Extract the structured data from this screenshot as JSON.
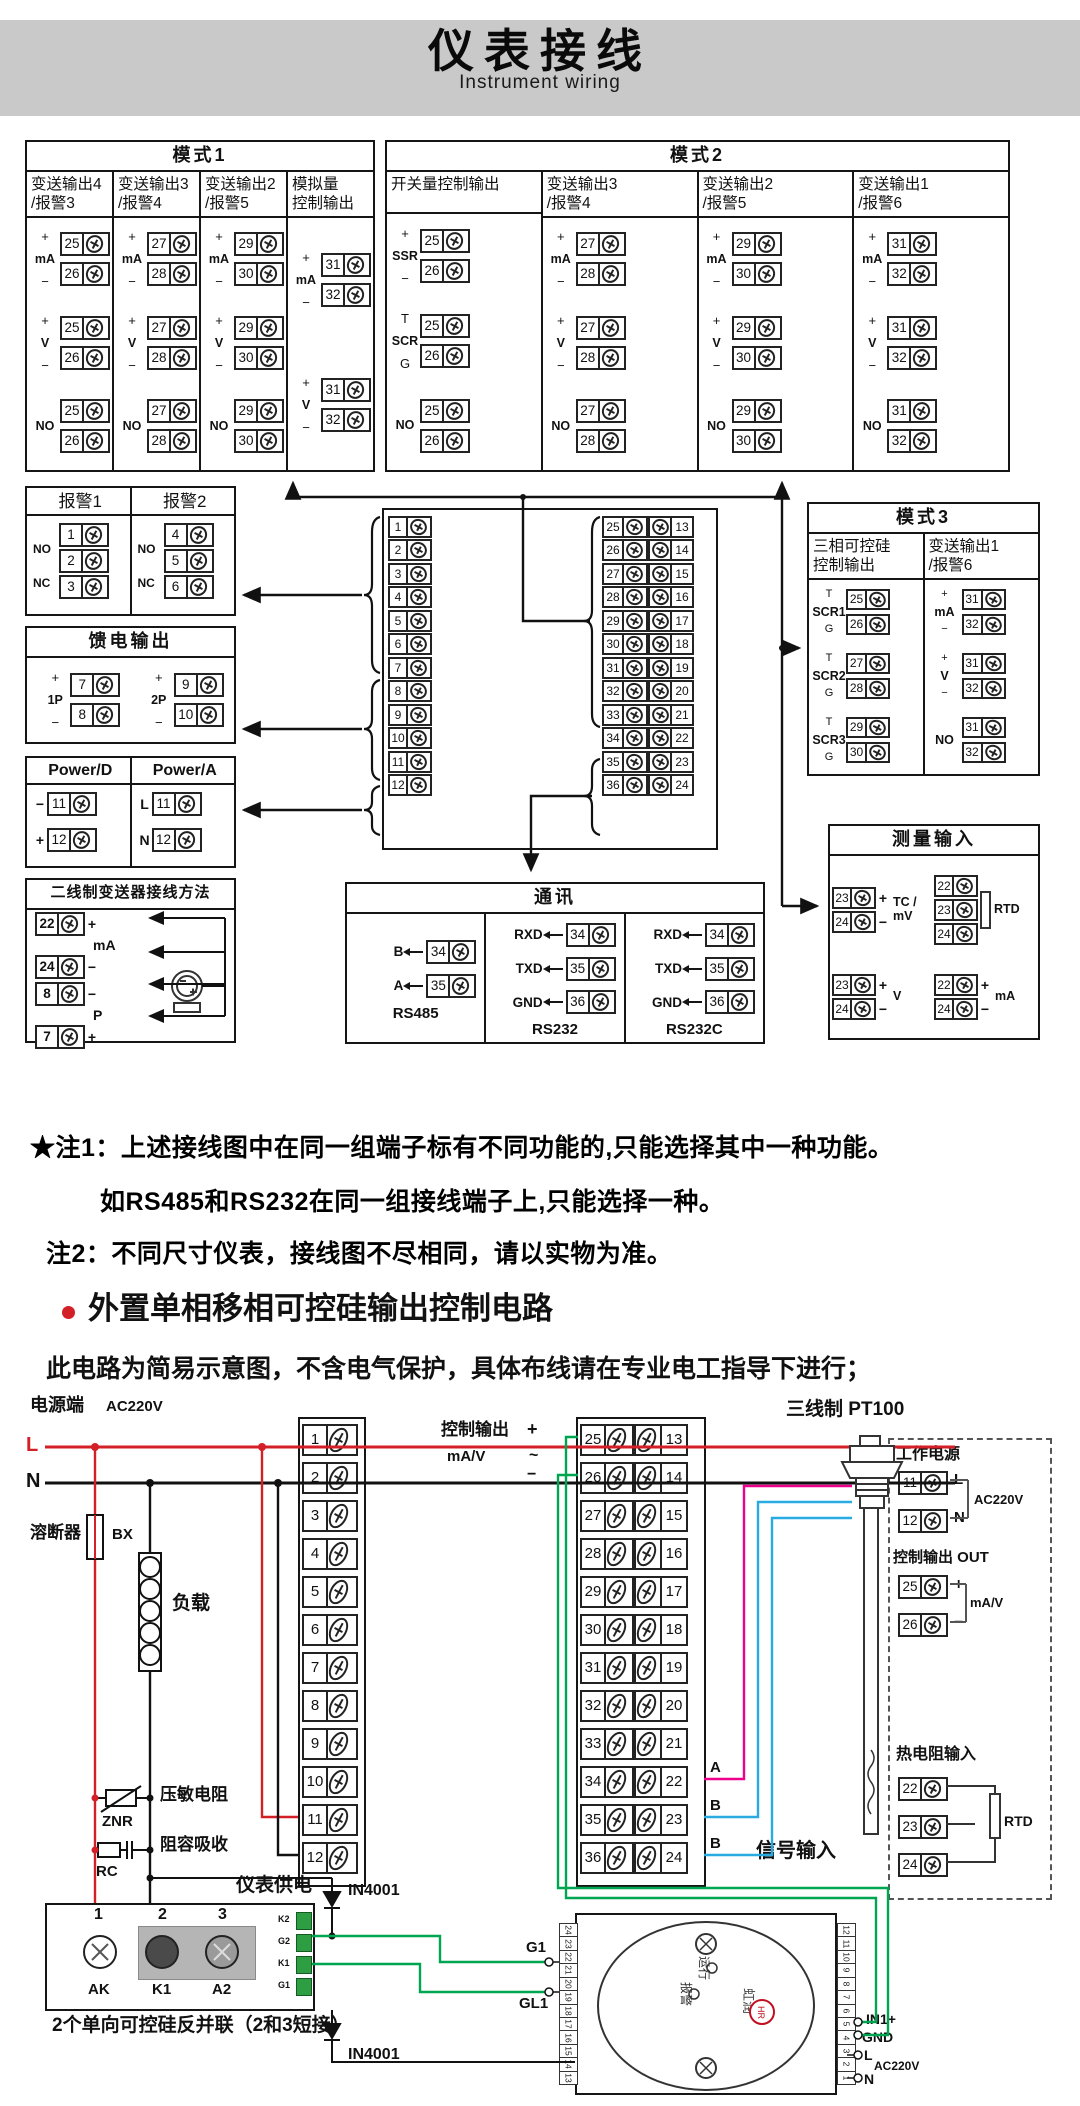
{
  "header": {
    "title_zh": "仪表接线",
    "title_en": "Instrument wiring"
  },
  "notes": {
    "n1a": "★注1：上述接线图中在同一组端子标有不同功能的,只能选择其中一种功能。",
    "n1b": "如RS485和RS232在同一组接线端子上,只能选择一种。",
    "n2": "注2：不同尺寸仪表，接线图不尽相同，请以实物为准。"
  },
  "section2": {
    "title": "外置单相移相可控硅输出控制电路",
    "subtitle": "此电路为简易示意图，不含电气保护，具体布线请在专业电工指导下进行；"
  },
  "mode_boxes": [
    {
      "id": "mode1",
      "title": "模式1",
      "columns": [
        {
          "header": [
            "变送输出4",
            "/报警3"
          ],
          "groups": [
            [
              "+",
              "mA",
              "−",
              "25",
              "26"
            ],
            [
              "+",
              "V",
              "−",
              "25",
              "26"
            ],
            [
              "",
              "NO",
              "",
              "25",
              "26"
            ]
          ]
        },
        {
          "header": [
            "变送输出3",
            "/报警4"
          ],
          "groups": [
            [
              "+",
              "mA",
              "−",
              "27",
              "28"
            ],
            [
              "+",
              "V",
              "−",
              "27",
              "28"
            ],
            [
              "",
              "NO",
              "",
              "27",
              "28"
            ]
          ]
        },
        {
          "header": [
            "变送输出2",
            "/报警5"
          ],
          "groups": [
            [
              "+",
              "mA",
              "−",
              "29",
              "30"
            ],
            [
              "+",
              "V",
              "−",
              "29",
              "30"
            ],
            [
              "",
              "NO",
              "",
              "29",
              "30"
            ]
          ]
        },
        {
          "header": [
            "模拟量",
            "控制输出"
          ],
          "groups": [
            [
              "+",
              "mA",
              "−",
              "31",
              "32"
            ],
            [
              "+",
              "V",
              "−",
              "31",
              "32"
            ]
          ]
        }
      ]
    },
    {
      "id": "mode2",
      "title": "模式2",
      "columns": [
        {
          "header": [
            "开关量控制输出",
            ""
          ],
          "groups": [
            [
              "+",
              "SSR",
              "−",
              "25",
              "26"
            ],
            [
              "T",
              "SCR",
              "G",
              "25",
              "26"
            ],
            [
              "",
              "NO",
              "",
              "25",
              "26"
            ]
          ]
        },
        {
          "header": [
            "变送输出3",
            "/报警4"
          ],
          "groups": [
            [
              "+",
              "mA",
              "−",
              "27",
              "28"
            ],
            [
              "+",
              "V",
              "−",
              "27",
              "28"
            ],
            [
              "",
              "NO",
              "",
              "27",
              "28"
            ]
          ]
        },
        {
          "header": [
            "变送输出2",
            "/报警5"
          ],
          "groups": [
            [
              "+",
              "mA",
              "−",
              "29",
              "30"
            ],
            [
              "+",
              "V",
              "−",
              "29",
              "30"
            ],
            [
              "",
              "NO",
              "",
              "29",
              "30"
            ]
          ]
        },
        {
          "header": [
            "变送输出1",
            "/报警6"
          ],
          "groups": [
            [
              "+",
              "mA",
              "−",
              "31",
              "32"
            ],
            [
              "+",
              "V",
              "−",
              "31",
              "32"
            ],
            [
              "",
              "NO",
              "",
              "31",
              "32"
            ]
          ]
        }
      ]
    },
    {
      "id": "mode3",
      "title": "模式3",
      "columns": [
        {
          "header": [
            "三相可控硅",
            "控制输出"
          ],
          "groups": [
            [
              "T",
              "SCR1",
              "G",
              "25",
              "26"
            ],
            [
              "T",
              "SCR2",
              "G",
              "27",
              "28"
            ],
            [
              "T",
              "SCR3",
              "G",
              "29",
              "30"
            ]
          ]
        },
        {
          "header": [
            "变送输出1",
            "/报警6"
          ],
          "groups": [
            [
              "+",
              "mA",
              "−",
              "31",
              "32"
            ],
            [
              "+",
              "V",
              "−",
              "31",
              "32"
            ],
            [
              "",
              "NO",
              "",
              "31",
              "32"
            ]
          ]
        }
      ]
    }
  ],
  "alarm": {
    "cols": [
      {
        "title": "报警1",
        "terms": [
          "1",
          "2",
          "3"
        ],
        "links": [
          "NO",
          "NC"
        ]
      },
      {
        "title": "报警2",
        "terms": [
          "4",
          "5",
          "6"
        ],
        "links": [
          "NO",
          "NC"
        ]
      }
    ]
  },
  "feed": {
    "title": "馈电输出",
    "groups": [
      [
        "+",
        "1P",
        "−",
        "7",
        "8"
      ],
      [
        "+",
        "2P",
        "−",
        "9",
        "10"
      ]
    ]
  },
  "power": {
    "cols": [
      {
        "title": "Power/D",
        "rows": [
          [
            "−",
            "11"
          ],
          [
            "+",
            "12"
          ]
        ]
      },
      {
        "title": "Power/A",
        "rows": [
          [
            "L",
            "11"
          ],
          [
            "N",
            "12"
          ]
        ]
      }
    ]
  },
  "twowire": {
    "title": "二线制变送器接线方法",
    "rows": [
      [
        "22",
        "+"
      ],
      [
        "24",
        "−"
      ],
      [
        "8",
        "−"
      ],
      [
        "7",
        "+"
      ]
    ],
    "mid1": "mA",
    "mid2": "P"
  },
  "comm": {
    "title": "通讯",
    "cols": [
      {
        "label": "RS485",
        "rows": [
          [
            "B",
            "34"
          ],
          [
            "A",
            "35"
          ]
        ]
      },
      {
        "label": "RS232",
        "rows": [
          [
            "RXD",
            "34"
          ],
          [
            "TXD",
            "35"
          ],
          [
            "GND",
            "36"
          ]
        ]
      },
      {
        "label": "RS232C",
        "rows": [
          [
            "RXD",
            "34"
          ],
          [
            "TXD",
            "35"
          ],
          [
            "GND",
            "36"
          ]
        ]
      }
    ]
  },
  "measure": {
    "title": "测量输入",
    "groups": [
      {
        "terms": [
          [
            "23",
            "+"
          ],
          [
            "24",
            "−"
          ]
        ],
        "label": "TC / mV"
      },
      {
        "terms": [
          [
            "22",
            ""
          ],
          [
            "23",
            ""
          ],
          [
            "24",
            ""
          ]
        ],
        "label": "RTD"
      },
      {
        "terms": [
          [
            "23",
            "+"
          ],
          [
            "24",
            "−"
          ]
        ],
        "label": "V"
      },
      {
        "terms": [
          [
            "22",
            "+"
          ],
          [
            "24",
            "−"
          ]
        ],
        "label": "mA"
      }
    ]
  },
  "strips": {
    "left": [
      "1",
      "2",
      "3",
      "4",
      "5",
      "6",
      "7",
      "8",
      "9",
      "10",
      "11",
      "12"
    ],
    "inner": [
      "25",
      "26",
      "27",
      "28",
      "29",
      "30",
      "31",
      "32",
      "33",
      "34",
      "35",
      "36"
    ],
    "outer": [
      "13",
      "14",
      "15",
      "16",
      "17",
      "18",
      "19",
      "20",
      "21",
      "22",
      "23",
      "24"
    ]
  },
  "bottom": {
    "power_side": "电源端",
    "ac": "AC220V",
    "l": "L",
    "n": "N",
    "fuse": "溶断器",
    "bx": "BX",
    "load": "负载",
    "znr_label": "压敏电阻",
    "znr": "ZNR",
    "rc_label": "阻容吸收",
    "rc": "RC",
    "supply": "仪表供电",
    "ctrl": "控制输出",
    "plus": "+",
    "minus": "−",
    "tilde": "~",
    "mav": "mA/V",
    "abb": [
      "A",
      "B",
      "B"
    ],
    "signal": "信号输入",
    "pt100": "三线制 PT100",
    "diode": "IN4001",
    "module": {
      "nums": [
        "1",
        "2",
        "3"
      ],
      "pins": [
        "AK",
        "K1",
        "A2"
      ],
      "mini": [
        "K2",
        "G2",
        "K1",
        "G1"
      ],
      "caption": "2个单向可控硅反并联（2和3短接）"
    },
    "panel": {
      "power_title": "工作电源",
      "power_rows": [
        [
          "11",
          "L"
        ],
        [
          "12",
          "N"
        ]
      ],
      "ac": "AC220V",
      "out_title": "控制输出 OUT",
      "out_rows": [
        [
          "25",
          "+"
        ],
        [
          "26",
          "−"
        ]
      ],
      "mav": "mA/V",
      "rtd_title": "热电阻输入",
      "rtd_rows": [
        "22",
        "23",
        "24"
      ],
      "rtd": "RTD"
    },
    "device": {
      "left_nums": [
        "24",
        "23",
        "22",
        "21",
        "20",
        "19",
        "18",
        "17",
        "16",
        "15",
        "14",
        "13"
      ],
      "right_nums": [
        "12",
        "11",
        "10",
        "9",
        "8",
        "7",
        "6",
        "5",
        "4",
        "3",
        "2",
        "1"
      ],
      "run": "运行",
      "alm": "报警",
      "brand": "虹润",
      "logo": "HR",
      "g1": "G1",
      "gl1": "GL1",
      "in1": "IN1+",
      "gnd": "GND",
      "l": "L",
      "ac": "AC220V",
      "n": "N"
    }
  },
  "colors": {
    "red": "#d31f26",
    "green": "#00a551",
    "cyan": "#29abe2",
    "magenta": "#ec008c",
    "band": "#c9c9c9"
  }
}
